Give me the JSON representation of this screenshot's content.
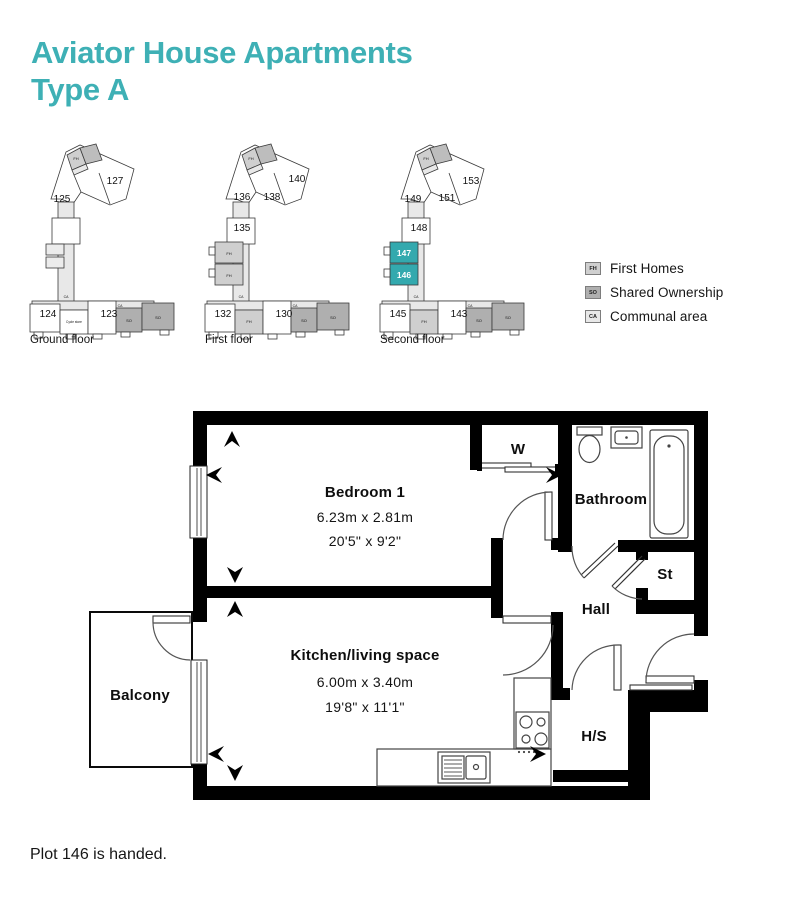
{
  "title": {
    "line1": "Aviator House Apartments",
    "line2": "Type A"
  },
  "note": "Plot 146 is handed.",
  "colors": {
    "accent": "#3EB0B5",
    "HL": "#33A9AE",
    "FH": "#CFCFCF",
    "FH2": "#BDBDBD",
    "SO": "#AFAFAF",
    "CA": "#E8E8E8",
    "plan_stroke": "#3A3A3A",
    "wall": "#000000"
  },
  "legend": {
    "items": [
      {
        "code": "FH",
        "label": "First Homes",
        "color_key": "FH"
      },
      {
        "code": "SO",
        "label": "Shared Ownership",
        "color_key": "SO"
      },
      {
        "code": "CA",
        "label": "Communal area",
        "color_key": "CA"
      }
    ]
  },
  "floor_plans": [
    {
      "name": "Ground floor",
      "shapes": [
        {
          "t": "poly",
          "pts": "29,57 44,10 58,3 112,27 104,57 88,63 59,50 51,62 39,57",
          "f": "#FFFFFF"
        },
        {
          "t": "poly",
          "pts": "45,13 58,6 64,22 50,28",
          "f": "FH"
        },
        {
          "t": "poly",
          "pts": "58,6 74,2 80,18 64,22",
          "f": "FH2"
        },
        {
          "t": "poly",
          "pts": "50,28 64,22 66,27 52,33",
          "f": "CA"
        },
        {
          "t": "line",
          "x1": 52,
          "y1": 33,
          "x2": 59,
          "y2": 50
        },
        {
          "t": "line",
          "x1": 77,
          "y1": 31,
          "x2": 88,
          "y2": 62
        },
        {
          "t": "rect",
          "x": 36,
          "y": 60,
          "w": 16,
          "h": 102,
          "f": "CA"
        },
        {
          "t": "rect",
          "x": 30,
          "y": 76,
          "w": 28,
          "h": 26,
          "f": "#FFFFFF"
        },
        {
          "t": "rect",
          "x": 24,
          "y": 102,
          "w": 18,
          "h": 11,
          "f": "#ECECEC"
        },
        {
          "t": "rect",
          "x": 24,
          "y": 115,
          "w": 18,
          "h": 11,
          "f": "#ECECEC"
        },
        {
          "t": "rect",
          "x": 10,
          "y": 159,
          "w": 122,
          "h": 9,
          "f": "CA"
        },
        {
          "t": "rect",
          "x": 8,
          "y": 162,
          "w": 30,
          "h": 28,
          "f": "#FFFFFF"
        },
        {
          "t": "rect",
          "x": 38,
          "y": 168,
          "w": 28,
          "h": 24,
          "f": "#FFFFFF"
        },
        {
          "t": "rect",
          "x": 66,
          "y": 159,
          "w": 28,
          "h": 33,
          "f": "#FFFFFF"
        },
        {
          "t": "rect",
          "x": 94,
          "y": 166,
          "w": 26,
          "h": 24,
          "f": "SO"
        },
        {
          "t": "rect",
          "x": 120,
          "y": 161,
          "w": 32,
          "h": 27,
          "f": "SO"
        },
        {
          "t": "rect",
          "x": 12,
          "y": 190,
          "w": 9,
          "h": 6,
          "f": "#FFFFFF"
        },
        {
          "t": "rect",
          "x": 44,
          "y": 192,
          "w": 9,
          "h": 5,
          "f": "#FFFFFF"
        },
        {
          "t": "rect",
          "x": 71,
          "y": 192,
          "w": 9,
          "h": 5,
          "f": "#FFFFFF"
        },
        {
          "t": "rect",
          "x": 99,
          "y": 190,
          "w": 9,
          "h": 5,
          "f": "#FFFFFF"
        },
        {
          "t": "rect",
          "x": 138,
          "y": 188,
          "w": 9,
          "h": 5,
          "f": "#FFFFFF"
        }
      ],
      "labels": [
        {
          "text": "125",
          "x": 40,
          "y": 60,
          "s": 10
        },
        {
          "text": "127",
          "x": 93,
          "y": 42,
          "s": 10
        },
        {
          "text": "FH",
          "x": 54,
          "y": 18,
          "s": 4
        },
        {
          "text": "CA",
          "x": 44,
          "y": 156,
          "s": 3.5
        },
        {
          "text": "CA",
          "x": 98,
          "y": 165,
          "s": 3.5
        },
        {
          "text": "124",
          "x": 26,
          "y": 175,
          "s": 10
        },
        {
          "text": "Cycle store",
          "x": 52,
          "y": 181,
          "s": 3.2
        },
        {
          "text": "123",
          "x": 87,
          "y": 175,
          "s": 10
        },
        {
          "text": "SO",
          "x": 107,
          "y": 180,
          "s": 4
        },
        {
          "text": "SO",
          "x": 136,
          "y": 177,
          "s": 4
        }
      ]
    },
    {
      "name": "First floor",
      "shapes": [
        {
          "t": "poly",
          "pts": "29,57 44,10 58,3 112,27 104,57 88,63 59,50 51,62 39,57",
          "f": "#FFFFFF"
        },
        {
          "t": "poly",
          "pts": "45,13 58,6 64,22 50,28",
          "f": "FH"
        },
        {
          "t": "poly",
          "pts": "58,6 74,2 80,18 64,22",
          "f": "FH2"
        },
        {
          "t": "poly",
          "pts": "50,28 64,22 66,27 52,33",
          "f": "CA"
        },
        {
          "t": "line",
          "x1": 52,
          "y1": 33,
          "x2": 59,
          "y2": 50
        },
        {
          "t": "line",
          "x1": 77,
          "y1": 31,
          "x2": 88,
          "y2": 62
        },
        {
          "t": "rect",
          "x": 36,
          "y": 60,
          "w": 16,
          "h": 102,
          "f": "CA"
        },
        {
          "t": "rect",
          "x": 30,
          "y": 76,
          "w": 28,
          "h": 26,
          "f": "#FFFFFF"
        },
        {
          "t": "rect",
          "x": 18,
          "y": 100,
          "w": 28,
          "h": 21,
          "f": "FH"
        },
        {
          "t": "rect",
          "x": 18,
          "y": 122,
          "w": 28,
          "h": 21,
          "f": "FH"
        },
        {
          "t": "rect",
          "x": 12,
          "y": 105,
          "w": 6,
          "h": 8,
          "f": "#FFFFFF"
        },
        {
          "t": "rect",
          "x": 12,
          "y": 127,
          "w": 6,
          "h": 8,
          "f": "#FFFFFF"
        },
        {
          "t": "rect",
          "x": 10,
          "y": 159,
          "w": 122,
          "h": 9,
          "f": "CA"
        },
        {
          "t": "rect",
          "x": 8,
          "y": 162,
          "w": 30,
          "h": 28,
          "f": "#FFFFFF"
        },
        {
          "t": "rect",
          "x": 38,
          "y": 168,
          "w": 28,
          "h": 24,
          "f": "FH"
        },
        {
          "t": "rect",
          "x": 66,
          "y": 159,
          "w": 28,
          "h": 33,
          "f": "#FFFFFF"
        },
        {
          "t": "rect",
          "x": 94,
          "y": 166,
          "w": 26,
          "h": 24,
          "f": "SO"
        },
        {
          "t": "rect",
          "x": 120,
          "y": 161,
          "w": 32,
          "h": 27,
          "f": "SO"
        },
        {
          "t": "rect",
          "x": 12,
          "y": 190,
          "w": 9,
          "h": 6,
          "f": "#FFFFFF"
        },
        {
          "t": "rect",
          "x": 44,
          "y": 192,
          "w": 9,
          "h": 5,
          "f": "#FFFFFF"
        },
        {
          "t": "rect",
          "x": 71,
          "y": 192,
          "w": 9,
          "h": 5,
          "f": "#FFFFFF"
        },
        {
          "t": "rect",
          "x": 99,
          "y": 190,
          "w": 9,
          "h": 5,
          "f": "#FFFFFF"
        },
        {
          "t": "rect",
          "x": 138,
          "y": 188,
          "w": 9,
          "h": 5,
          "f": "#FFFFFF"
        }
      ],
      "labels": [
        {
          "text": "136",
          "x": 45,
          "y": 58,
          "s": 10
        },
        {
          "text": "138",
          "x": 75,
          "y": 58,
          "s": 10
        },
        {
          "text": "140",
          "x": 100,
          "y": 40,
          "s": 10
        },
        {
          "text": "FH",
          "x": 54,
          "y": 18,
          "s": 4
        },
        {
          "text": "135",
          "x": 45,
          "y": 89,
          "s": 10
        },
        {
          "text": "FH",
          "x": 32,
          "y": 113,
          "s": 4
        },
        {
          "text": "FH",
          "x": 32,
          "y": 135,
          "s": 4
        },
        {
          "text": "CA",
          "x": 44,
          "y": 156,
          "s": 3.5
        },
        {
          "text": "CA",
          "x": 98,
          "y": 165,
          "s": 3.5
        },
        {
          "text": "132",
          "x": 26,
          "y": 175,
          "s": 10
        },
        {
          "text": "FH",
          "x": 52,
          "y": 181,
          "s": 4
        },
        {
          "text": "130",
          "x": 87,
          "y": 175,
          "s": 10
        },
        {
          "text": "SO",
          "x": 107,
          "y": 180,
          "s": 4
        },
        {
          "text": "SO",
          "x": 136,
          "y": 177,
          "s": 4
        }
      ]
    },
    {
      "name": "Second floor",
      "shapes": [
        {
          "t": "poly",
          "pts": "29,57 44,10 58,3 112,27 104,57 88,63 59,50 51,62 39,57",
          "f": "#FFFFFF"
        },
        {
          "t": "poly",
          "pts": "45,13 58,6 64,22 50,28",
          "f": "FH"
        },
        {
          "t": "poly",
          "pts": "58,6 74,2 80,18 64,22",
          "f": "FH2"
        },
        {
          "t": "poly",
          "pts": "50,28 64,22 66,27 52,33",
          "f": "CA"
        },
        {
          "t": "line",
          "x1": 52,
          "y1": 33,
          "x2": 59,
          "y2": 50
        },
        {
          "t": "line",
          "x1": 77,
          "y1": 31,
          "x2": 88,
          "y2": 62
        },
        {
          "t": "rect",
          "x": 36,
          "y": 60,
          "w": 16,
          "h": 102,
          "f": "CA"
        },
        {
          "t": "rect",
          "x": 30,
          "y": 76,
          "w": 28,
          "h": 26,
          "f": "#FFFFFF"
        },
        {
          "t": "rect",
          "x": 18,
          "y": 100,
          "w": 28,
          "h": 21,
          "f": "HL"
        },
        {
          "t": "rect",
          "x": 18,
          "y": 122,
          "w": 28,
          "h": 21,
          "f": "HL"
        },
        {
          "t": "rect",
          "x": 12,
          "y": 105,
          "w": 6,
          "h": 8,
          "f": "#FFFFFF"
        },
        {
          "t": "rect",
          "x": 12,
          "y": 127,
          "w": 6,
          "h": 8,
          "f": "#FFFFFF"
        },
        {
          "t": "rect",
          "x": 10,
          "y": 159,
          "w": 122,
          "h": 9,
          "f": "CA"
        },
        {
          "t": "rect",
          "x": 8,
          "y": 162,
          "w": 30,
          "h": 28,
          "f": "#FFFFFF"
        },
        {
          "t": "rect",
          "x": 38,
          "y": 168,
          "w": 28,
          "h": 24,
          "f": "FH"
        },
        {
          "t": "rect",
          "x": 66,
          "y": 159,
          "w": 28,
          "h": 33,
          "f": "#FFFFFF"
        },
        {
          "t": "rect",
          "x": 94,
          "y": 166,
          "w": 26,
          "h": 24,
          "f": "SO"
        },
        {
          "t": "rect",
          "x": 120,
          "y": 161,
          "w": 32,
          "h": 27,
          "f": "SO"
        },
        {
          "t": "rect",
          "x": 12,
          "y": 190,
          "w": 9,
          "h": 6,
          "f": "#FFFFFF"
        },
        {
          "t": "rect",
          "x": 44,
          "y": 192,
          "w": 9,
          "h": 5,
          "f": "#FFFFFF"
        },
        {
          "t": "rect",
          "x": 71,
          "y": 192,
          "w": 9,
          "h": 5,
          "f": "#FFFFFF"
        },
        {
          "t": "rect",
          "x": 99,
          "y": 190,
          "w": 9,
          "h": 5,
          "f": "#FFFFFF"
        },
        {
          "t": "rect",
          "x": 138,
          "y": 188,
          "w": 9,
          "h": 5,
          "f": "#FFFFFF"
        }
      ],
      "labels": [
        {
          "text": "149",
          "x": 41,
          "y": 60,
          "s": 10
        },
        {
          "text": "151",
          "x": 75,
          "y": 59,
          "s": 10
        },
        {
          "text": "153",
          "x": 99,
          "y": 42,
          "s": 10
        },
        {
          "text": "FH",
          "x": 54,
          "y": 18,
          "s": 4
        },
        {
          "text": "148",
          "x": 47,
          "y": 89,
          "s": 10
        },
        {
          "text": "147",
          "x": 32,
          "y": 114,
          "s": 8.5,
          "c": "#FFFFFF",
          "w": 700
        },
        {
          "text": "146",
          "x": 32,
          "y": 136,
          "s": 8.5,
          "c": "#FFFFFF",
          "w": 700
        },
        {
          "text": "CA",
          "x": 44,
          "y": 156,
          "s": 3.5
        },
        {
          "text": "CA",
          "x": 98,
          "y": 165,
          "s": 3.5
        },
        {
          "text": "145",
          "x": 26,
          "y": 175,
          "s": 10
        },
        {
          "text": "FH",
          "x": 52,
          "y": 181,
          "s": 4
        },
        {
          "text": "143",
          "x": 87,
          "y": 175,
          "s": 10
        },
        {
          "text": "SO",
          "x": 107,
          "y": 180,
          "s": 4
        },
        {
          "text": "SO",
          "x": 136,
          "y": 177,
          "s": 4
        }
      ]
    }
  ],
  "apartment": {
    "bedroom": {
      "name": "Bedroom 1",
      "metric": "6.23m x 2.81m",
      "imperial": "20'5\" x 9'2\""
    },
    "kitchen": {
      "name": "Kitchen/living space",
      "metric": "6.00m x 3.40m",
      "imperial": "19'8\" x 11'1\""
    },
    "bathroom": {
      "name": "Bathroom"
    },
    "hall": {
      "name": "Hall"
    },
    "store": {
      "name": "St"
    },
    "hs": {
      "name": "H/S"
    },
    "wardrobe": {
      "name": "W"
    },
    "balcony": {
      "name": "Balcony"
    }
  }
}
